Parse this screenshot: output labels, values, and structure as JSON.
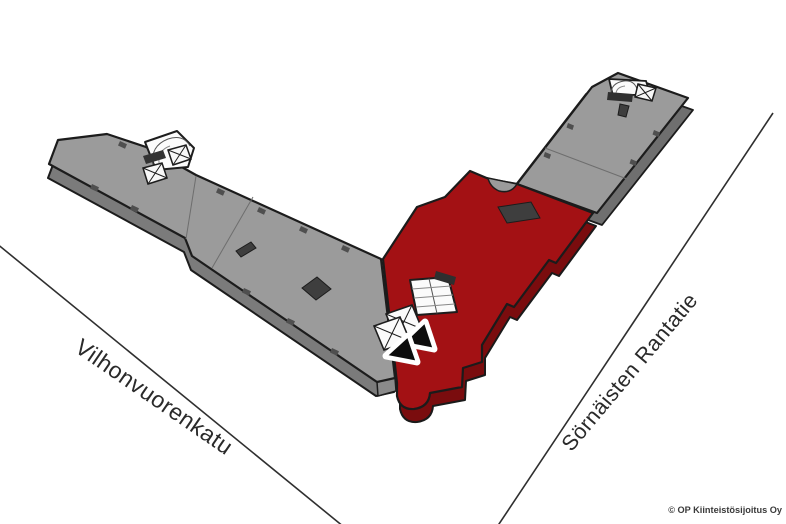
{
  "streets": {
    "left": {
      "label": "Vilhonvuorenkatu"
    },
    "right": {
      "label": "Sörnäisten Rantatie"
    }
  },
  "footer": {
    "copyright": "© OP Kiinteistösijoitus Oy"
  },
  "building": {
    "sections": {
      "left_wing": {
        "name": "left wing",
        "highlighted": false
      },
      "right_wing": {
        "name": "right wing",
        "highlighted": false
      },
      "corner": {
        "name": "corner section",
        "highlighted": true
      }
    }
  },
  "colors": {
    "background": "#ffffff",
    "deck_gray": "#9b9b9b",
    "deck_gray_side": "#7b7b7b",
    "deck_gray_side_mid": "#6f6f6f",
    "deck_gray_side_dark": "#474747",
    "end_face": "#8a8a8a",
    "red_top": "#a31114",
    "red_side": "#7a0c0e",
    "skylight": "#3e3e3e",
    "core_white": "#fbfbfb",
    "outline": "#1c1c1c",
    "street_line": "#2f2f2f"
  },
  "icons": {
    "elevator": "x-box",
    "escalator_arrow": "filled-triangle",
    "stairs": "fan-arc",
    "skylight": "dark-rect"
  }
}
